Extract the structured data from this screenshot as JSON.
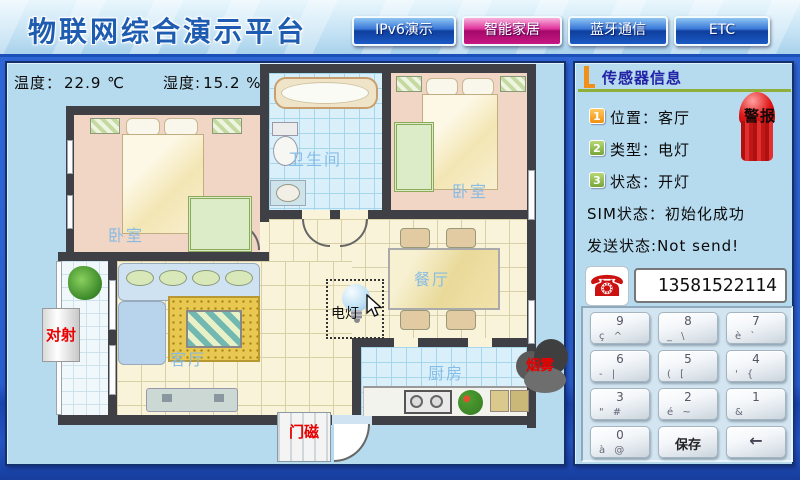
{
  "header": {
    "title": "物联网综合演示平台",
    "tabs": [
      {
        "label": "IPv6演示",
        "active": false
      },
      {
        "label": "智能家居",
        "active": true
      },
      {
        "label": "蓝牙通信",
        "active": false
      },
      {
        "label": "ETC",
        "active": false
      }
    ]
  },
  "environment": {
    "temperature_label": "温度：",
    "temperature_value": "22.9 ℃",
    "humidity_label": "湿度:",
    "humidity_value": "15.2 %"
  },
  "floorplan": {
    "rooms": {
      "bedroom1": "卧室",
      "bathroom": "卫生间",
      "bedroom2": "卧室",
      "dining": "餐厅",
      "living": "客厅",
      "kitchen": "厨房"
    },
    "devices": {
      "beam": "对射",
      "lamp": "电灯",
      "smoke": "烟雾",
      "door_magnet": "门磁"
    }
  },
  "sensor_panel": {
    "title": "传感器信息",
    "alarm_label": "警报",
    "rows": [
      {
        "num": "1",
        "label": "位置：",
        "value": "客厅"
      },
      {
        "num": "2",
        "label": "类型：",
        "value": "电灯"
      },
      {
        "num": "3",
        "label": "状态：",
        "value": "开灯"
      }
    ],
    "sim_label": "SIM状态：",
    "sim_value": "初始化成功",
    "send_label": "发送状态:",
    "send_value": "Not send!",
    "phone_number": "13581522114",
    "keypad": {
      "keys": [
        {
          "main": "9",
          "sub": "ç ^"
        },
        {
          "main": "8",
          "sub": "_ \\"
        },
        {
          "main": "7",
          "sub": "è `"
        },
        {
          "main": "6",
          "sub": "- |"
        },
        {
          "main": "5",
          "sub": "( ["
        },
        {
          "main": "4",
          "sub": "' {"
        },
        {
          "main": "3",
          "sub": "\" #"
        },
        {
          "main": "2",
          "sub": "é ~"
        },
        {
          "main": "1",
          "sub": "&"
        },
        {
          "main": "0",
          "sub": "à @"
        },
        {
          "main": "保存",
          "sub": ""
        },
        {
          "main": "←",
          "sub": ""
        }
      ]
    }
  },
  "colors": {
    "active_tab_magenta": "#c81884",
    "tab_blue": "#1b5ac4",
    "alarm_red": "#d81818",
    "device_label_red": "#e80000",
    "room_label_blue": "#82b9e6",
    "title_blue": "#1d5cb0"
  }
}
